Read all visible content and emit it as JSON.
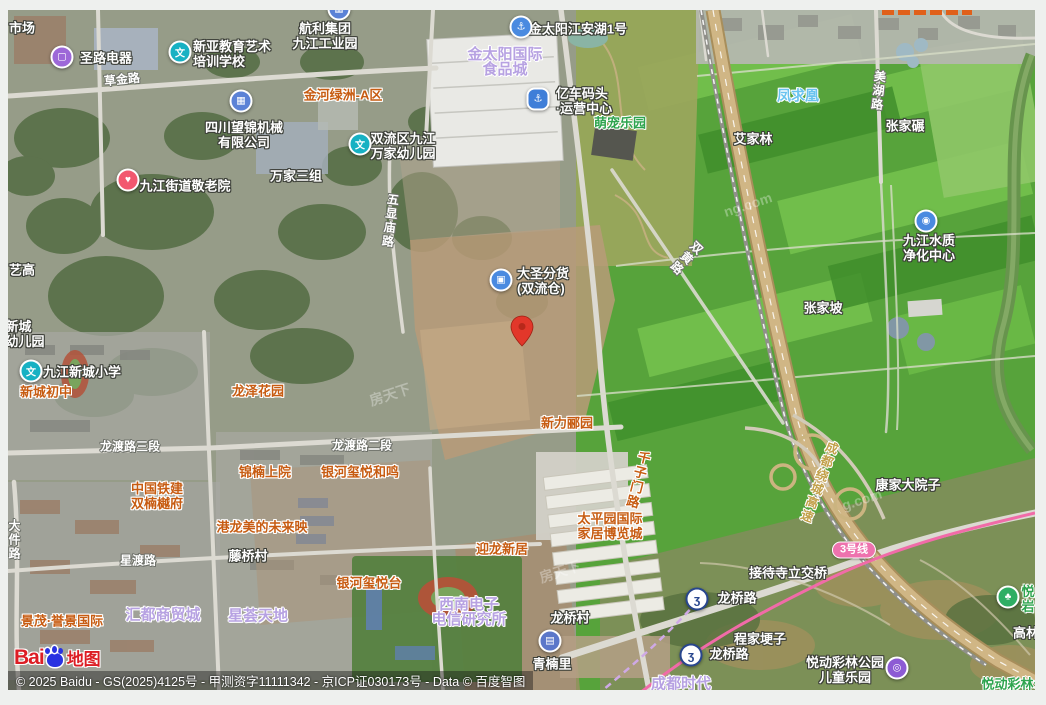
{
  "attribution": {
    "copyright": "© 2025 Baidu - GS(2025)4125号 - 甲测资字11111342 - 京ICP证030173号 - Data © 百度智图",
    "brand": {
      "latin": "Bai",
      "cn": "地图"
    }
  },
  "colors": {
    "orange": "#c75c12",
    "lilac": "#b7a2e2",
    "green": "#2ea44e",
    "cyan": "#69c3ef",
    "hwy": "#c2a04a",
    "badge": "#ee72ae",
    "metro": "#f16ba8",
    "pin": "#e2372a"
  },
  "icon_glyphs": {
    "school": "文",
    "shop": "▢",
    "anchor": "⚓",
    "anchor2": "⚓",
    "truck": "▣",
    "factory": "▦",
    "care": "♥",
    "water": "◉",
    "building": "▤",
    "metro": "ʒ",
    "park": "♣",
    "playground": "◎"
  },
  "pin": {
    "x": 522,
    "y": 352
  },
  "labels": [
    {
      "name": "label-market",
      "text": "市场",
      "x": 22,
      "y": 28,
      "cls": "w"
    },
    {
      "name": "poi-shenglu-electric",
      "text": "圣路电器",
      "x": 106,
      "y": 58,
      "cls": "w",
      "icon": {
        "type": "shop",
        "x": 62,
        "y": 57,
        "name": "shopping-bag-icon"
      }
    },
    {
      "name": "poi-xinya-art-school",
      "lines": [
        "新亚教育艺术",
        "培训学校"
      ],
      "x": 232,
      "y": 54,
      "cls": "w",
      "align": "l",
      "icon": {
        "type": "school",
        "x": 180,
        "y": 52,
        "name": "school-icon"
      }
    },
    {
      "name": "label-hangli-industrial-park",
      "lines": [
        "航利集团",
        "九江工业园"
      ],
      "x": 325,
      "y": 36,
      "cls": "w",
      "icon": {
        "type": "factory",
        "x": 339,
        "y": 9,
        "name": "factory-icon"
      }
    },
    {
      "name": "poi-jintaiyang-jiangan-lake",
      "text": "金太阳江安湖1号",
      "x": 578,
      "y": 29,
      "cls": "w",
      "icon": {
        "type": "anchor",
        "x": 521,
        "y": 27,
        "name": "anchor-icon"
      }
    },
    {
      "name": "label-jintaiyang-food-city",
      "lines": [
        "金太阳国际",
        "食品城"
      ],
      "x": 505,
      "y": 62,
      "cls": "lilac"
    },
    {
      "name": "label-jinhe-lvzhou-a",
      "text": "金河绿洲-A区",
      "x": 343,
      "y": 95,
      "cls": "orange"
    },
    {
      "name": "road-caojin-lu",
      "text": "草金路",
      "x": 122,
      "y": 80,
      "cls": "road",
      "rotate": -6
    },
    {
      "name": "poi-yiche-wharf",
      "lines": [
        "亿车码头",
        "·运营中心"
      ],
      "x": 584,
      "y": 101,
      "cls": "w",
      "align": "l",
      "icon": {
        "type": "anchor2",
        "x": 538,
        "y": 99,
        "name": "anchor-icon"
      }
    },
    {
      "name": "label-mengchong-park",
      "text": "萌宠乐园",
      "x": 620,
      "y": 123,
      "cls": "green"
    },
    {
      "name": "label-fengqiuhuang",
      "text": "凤求凰",
      "x": 798,
      "y": 96,
      "cls": "cyan"
    },
    {
      "name": "road-meihu-lu",
      "text": "美湖路",
      "x": 878,
      "y": 91,
      "cls": "road",
      "vertical": true,
      "rotate": 6
    },
    {
      "name": "label-zhangjia-nian",
      "text": "张家碾",
      "x": 905,
      "y": 126,
      "cls": "w"
    },
    {
      "name": "label-aijialin",
      "text": "艾家林",
      "x": 753,
      "y": 139,
      "cls": "w"
    },
    {
      "name": "poi-sichuan-wangjin-machinery",
      "lines": [
        "四川望锦机械",
        "有限公司"
      ],
      "x": 244,
      "y": 135,
      "cls": "w",
      "icon": {
        "type": "factory",
        "x": 241,
        "y": 101,
        "name": "factory-icon"
      }
    },
    {
      "name": "poi-jiujiang-nursing-home",
      "text": "九江街道敬老院",
      "x": 185,
      "y": 186,
      "cls": "w",
      "icon": {
        "type": "care",
        "x": 128,
        "y": 180,
        "name": "heart-care-icon"
      }
    },
    {
      "name": "label-wanjia-sanzu",
      "text": "万家三组",
      "x": 296,
      "y": 176,
      "cls": "w"
    },
    {
      "name": "poi-wanjia-kindergarten",
      "lines": [
        "双流区九江",
        "万家幼儿园"
      ],
      "x": 403,
      "y": 146,
      "cls": "w",
      "align": "l",
      "icon": {
        "type": "school",
        "x": 360,
        "y": 144,
        "name": "school-icon"
      }
    },
    {
      "name": "road-wuxianmiao-lu",
      "text": "五显庙路",
      "x": 390,
      "y": 221,
      "cls": "road",
      "vertical": true,
      "rotate": 7
    },
    {
      "name": "label-yigao",
      "text": "艺高",
      "x": 22,
      "y": 270,
      "cls": "w"
    },
    {
      "name": "poi-dasheng-warehouse",
      "lines": [
        "大圣分货",
        "(双流仓)"
      ],
      "x": 543,
      "y": 281,
      "cls": "w",
      "align": "l",
      "icon": {
        "type": "truck",
        "x": 501,
        "y": 280,
        "name": "truck-icon"
      }
    },
    {
      "name": "road-shuanghuang-lu",
      "text": "双黄路",
      "x": 686,
      "y": 258,
      "cls": "road",
      "vertical": true,
      "rotate": 44
    },
    {
      "name": "poi-jiujiang-water-plant",
      "lines": [
        "九江水质",
        "净化中心"
      ],
      "x": 929,
      "y": 248,
      "cls": "w",
      "icon": {
        "type": "water",
        "x": 926,
        "y": 221,
        "name": "water-drop-icon"
      }
    },
    {
      "name": "label-zhangjiapo",
      "text": "张家坡",
      "x": 823,
      "y": 308,
      "cls": "w"
    },
    {
      "name": "label-xincheng-kindergarten",
      "lines": [
        "新城",
        "幼儿园"
      ],
      "x": 25,
      "y": 334,
      "cls": "w",
      "align": "l"
    },
    {
      "name": "poi-jiujiang-xincheng-primary",
      "text": "九江新城小学",
      "x": 82,
      "y": 372,
      "cls": "w",
      "icon": {
        "type": "school",
        "x": 31,
        "y": 371,
        "name": "school-icon"
      }
    },
    {
      "name": "label-xincheng-middle-school",
      "text": "新城初中",
      "x": 46,
      "y": 392,
      "cls": "orange"
    },
    {
      "name": "label-longze-garden",
      "text": "龙泽花园",
      "x": 258,
      "y": 391,
      "cls": "orange"
    },
    {
      "name": "road-longdu-lu-3",
      "text": "龙渡路三段",
      "x": 130,
      "y": 447,
      "cls": "road"
    },
    {
      "name": "road-longdu-lu-2",
      "text": "龙渡路二段",
      "x": 362,
      "y": 446,
      "cls": "road"
    },
    {
      "name": "label-xinli-liyuan",
      "text": "新力郦园",
      "x": 567,
      "y": 423,
      "cls": "orange"
    },
    {
      "name": "road-qianzimen-lu",
      "text": "千子门路",
      "x": 637,
      "y": 480,
      "cls": "orange",
      "vertical": true,
      "rotate": 14
    },
    {
      "name": "label-jinnan-shangyuan",
      "text": "锦楠上院",
      "x": 265,
      "y": 472,
      "cls": "orange"
    },
    {
      "name": "label-yinhe-xiyue-heming",
      "text": "银河玺悦和鸣",
      "x": 360,
      "y": 472,
      "cls": "orange"
    },
    {
      "name": "label-zhongguo-tiejian-shuangnan",
      "lines": [
        "中国铁建",
        "双楠樾府"
      ],
      "x": 157,
      "y": 496,
      "cls": "orange"
    },
    {
      "name": "label-ganglong-meidi",
      "text": "港龙美的未来映",
      "x": 262,
      "y": 527,
      "cls": "orange"
    },
    {
      "name": "label-tengqiao-village",
      "text": "藤桥村",
      "x": 248,
      "y": 556,
      "cls": "w"
    },
    {
      "name": "road-xingdu-lu",
      "text": "星渡路",
      "x": 138,
      "y": 561,
      "cls": "road"
    },
    {
      "name": "road-dajian-lu",
      "text": "大件路",
      "x": 14,
      "y": 540,
      "cls": "road",
      "vertical": true
    },
    {
      "name": "label-taipingyuan-expo",
      "lines": [
        "太平园国际",
        "家居博览城"
      ],
      "x": 610,
      "y": 526,
      "cls": "orange"
    },
    {
      "name": "label-yinhe-xiyue-tai",
      "text": "银河玺悦台",
      "x": 369,
      "y": 583,
      "cls": "orange"
    },
    {
      "name": "label-yinglong-xinju",
      "text": "迎龙新居",
      "x": 502,
      "y": 549,
      "cls": "orange"
    },
    {
      "name": "label-jingmao-yujing",
      "text": "景茂·誉景国际",
      "x": 62,
      "y": 621,
      "cls": "orange"
    },
    {
      "name": "label-huidu-trade-city",
      "text": "汇都商贸城",
      "x": 163,
      "y": 615,
      "cls": "lilac"
    },
    {
      "name": "label-xinghui-tiandi",
      "text": "星荟天地",
      "x": 258,
      "y": 616,
      "cls": "lilac"
    },
    {
      "name": "label-southwest-electronics",
      "lines": [
        "西南电子",
        "电信研究所"
      ],
      "x": 469,
      "y": 612,
      "cls": "lilac"
    },
    {
      "name": "label-longqiao-village",
      "text": "龙桥村",
      "x": 570,
      "y": 618,
      "cls": "w"
    },
    {
      "name": "poi-qingnanli",
      "text": "青楠里",
      "x": 552,
      "y": 664,
      "cls": "w",
      "icon": {
        "type": "building",
        "x": 550,
        "y": 641,
        "name": "building-icon"
      }
    },
    {
      "name": "label-kangjia-dayuanzi",
      "text": "康家大院子",
      "x": 908,
      "y": 485,
      "cls": "w"
    },
    {
      "name": "road-chengdu-raocheng-gaosu",
      "text": "成都绕城高速",
      "x": 818,
      "y": 482,
      "cls": "hwy",
      "vertical": true,
      "rotate": 20
    },
    {
      "name": "badge-metro-line-3",
      "text": "3号线",
      "x": 854,
      "y": 550,
      "cls": "badge"
    },
    {
      "name": "label-jiedaisi-interchange",
      "text": "接待寺立交桥",
      "x": 788,
      "y": 573,
      "cls": "w"
    },
    {
      "name": "poi-longqiaolu-station-north",
      "text": "龙桥路",
      "x": 737,
      "y": 598,
      "cls": "w",
      "icon": {
        "type": "metro",
        "x": 697,
        "y": 599,
        "name": "metro-logo-icon"
      }
    },
    {
      "name": "label-chengjia-gengzi",
      "text": "程家埂子",
      "x": 760,
      "y": 639,
      "cls": "w"
    },
    {
      "name": "poi-longqiaolu-station-south",
      "text": "龙桥路",
      "x": 729,
      "y": 654,
      "cls": "w",
      "icon": {
        "type": "metro",
        "x": 691,
        "y": 655,
        "name": "metro-logo-icon"
      }
    },
    {
      "name": "label-chengdu-shidai",
      "text": "成都时代",
      "x": 681,
      "y": 684,
      "cls": "lilac"
    },
    {
      "name": "poi-yuedong-cailin-playground",
      "lines": [
        "悦动彩林公园",
        "儿童乐园"
      ],
      "x": 845,
      "y": 670,
      "cls": "w",
      "icon": {
        "type": "playground",
        "x": 897,
        "y": 668,
        "name": "playground-icon"
      }
    },
    {
      "name": "poi-yueyan",
      "lines": [
        "悦",
        "岩"
      ],
      "x": 1028,
      "y": 599,
      "cls": "green",
      "icon": {
        "type": "park",
        "x": 1008,
        "y": 597,
        "name": "tree-icon"
      }
    },
    {
      "name": "label-gaolin",
      "text": "高林",
      "x": 1026,
      "y": 633,
      "cls": "w"
    },
    {
      "name": "label-yuedong-cailin-park",
      "text": "悦动彩林公",
      "x": 1014,
      "y": 684,
      "cls": "green"
    },
    {
      "name": "watermark",
      "text": "房天下",
      "x": 390,
      "y": 395,
      "cls": "wm",
      "rotate": -18
    },
    {
      "name": "watermark",
      "text": "ng.com",
      "x": 748,
      "y": 205,
      "cls": "wm",
      "rotate": -18
    },
    {
      "name": "watermark",
      "text": "房天下",
      "x": 560,
      "y": 572,
      "cls": "wm",
      "rotate": -18
    },
    {
      "name": "watermark",
      "text": "g.com",
      "x": 862,
      "y": 500,
      "cls": "wm",
      "rotate": -18
    }
  ]
}
